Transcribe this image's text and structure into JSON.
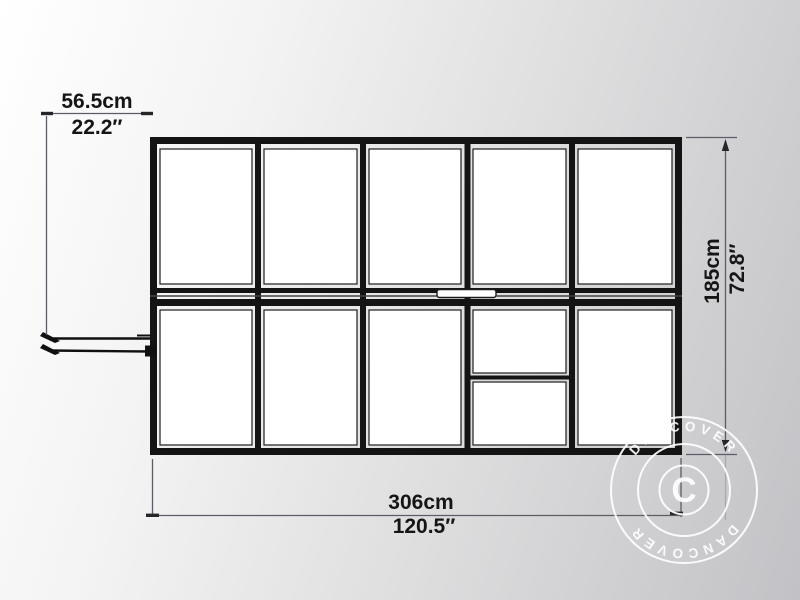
{
  "diagram": {
    "dimensions": {
      "top": {
        "metric": "56.5cm",
        "imperial": "22.2″"
      },
      "side": {
        "metric": "185cm",
        "imperial": "72.8″"
      },
      "bottom": {
        "metric": "306cm",
        "imperial": "120.5″"
      }
    },
    "grid": {
      "columns": 5,
      "rows": 2
    },
    "colors": {
      "frame": "#141414",
      "panel": "#ffffff",
      "dimension_line": "#5a5d63",
      "text": "#151515",
      "watermark": "#ffffff"
    }
  },
  "watermark": {
    "symbol": "C",
    "arc_top": "DANCOVER",
    "arc_bottom": "DANCOVER"
  }
}
